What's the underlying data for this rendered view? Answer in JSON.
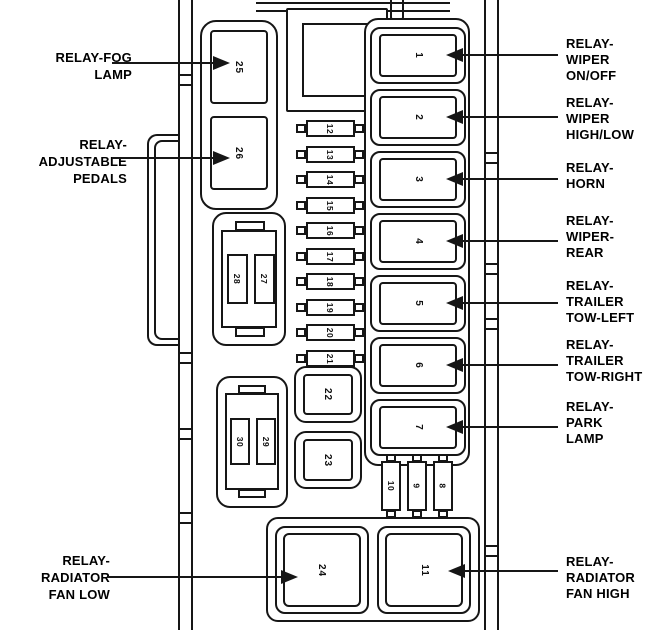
{
  "colors": {
    "line": "#161616",
    "background": "#ffffff",
    "text": "#000000"
  },
  "left_labels": [
    {
      "lines": [
        "RELAY-FOG",
        "LAMP"
      ],
      "target_relay": "25"
    },
    {
      "lines": [
        "RELAY-",
        "ADJUSTABLE",
        "PEDALS"
      ],
      "target_relay": "26"
    },
    {
      "lines": [
        "RELAY-",
        "RADIATOR",
        "FAN LOW"
      ],
      "target_relay": "24"
    }
  ],
  "right_labels": [
    {
      "lines": [
        "RELAY-",
        "WIPER",
        "ON/OFF"
      ],
      "target_relay": "1"
    },
    {
      "lines": [
        "RELAY-",
        "WIPER",
        "HIGH/LOW"
      ],
      "target_relay": "2"
    },
    {
      "lines": [
        "RELAY-",
        "HORN"
      ],
      "target_relay": "3"
    },
    {
      "lines": [
        "RELAY-",
        "WIPER-",
        "REAR"
      ],
      "target_relay": "4"
    },
    {
      "lines": [
        "RELAY-",
        "TRAILER",
        "TOW-LEFT"
      ],
      "target_relay": "5"
    },
    {
      "lines": [
        "RELAY-",
        "TRAILER",
        "TOW-RIGHT"
      ],
      "target_relay": "6"
    },
    {
      "lines": [
        "RELAY-",
        "PARK",
        "LAMP"
      ],
      "target_relay": "7"
    },
    {
      "lines": [
        "RELAY-",
        "RADIATOR",
        "FAN HIGH"
      ],
      "target_relay": "11"
    }
  ],
  "relays": {
    "column": [
      "1",
      "2",
      "3",
      "4",
      "5",
      "6",
      "7"
    ],
    "side": [
      "25",
      "26"
    ],
    "squares": [
      "22",
      "23"
    ],
    "bottom": [
      "24",
      "11"
    ]
  },
  "fuses": {
    "column": [
      "12",
      "13",
      "14",
      "15",
      "16",
      "17",
      "18",
      "19",
      "20",
      "21"
    ],
    "connector_a": [
      "28",
      "27"
    ],
    "connector_b": [
      "30",
      "29"
    ],
    "lower": [
      "10",
      "9",
      "8"
    ]
  }
}
